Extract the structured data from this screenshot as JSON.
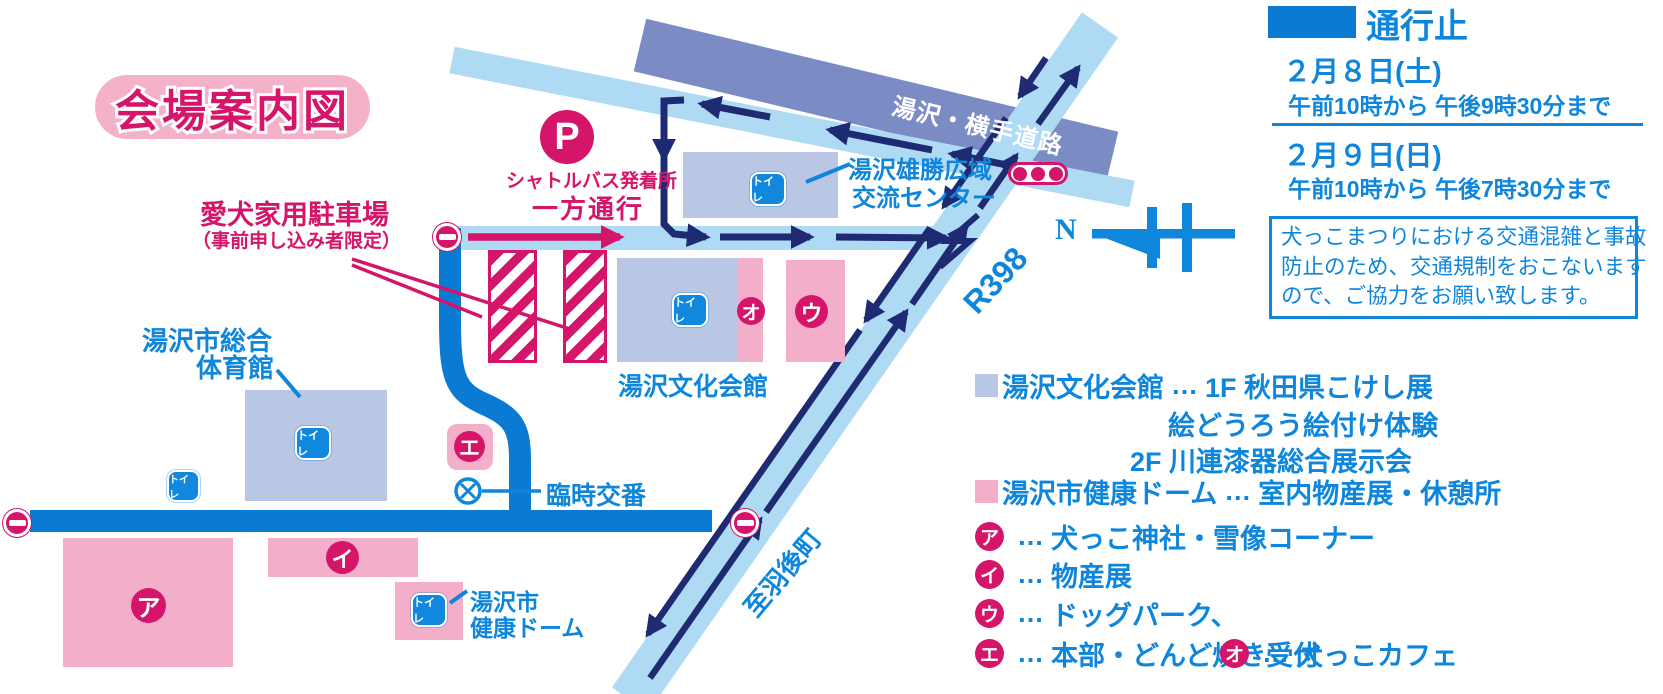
{
  "title": "会場案内図",
  "closure_legend": {
    "label": "通行止",
    "entries": [
      {
        "date": "２月８日(土)",
        "time": "午前10時から 午後9時30分まで"
      },
      {
        "date": "２月９日(日)",
        "time": "午前10時から 午後7時30分まで"
      }
    ],
    "notice_lines": [
      "犬っこまつりにおける交通混雑と事故",
      "防止のため、交通規制をおこないます",
      "ので、ご協力をお願い致します。"
    ]
  },
  "compass": {
    "label": "N"
  },
  "roads": {
    "yokote": "湯沢・横手道路",
    "r398": "R398",
    "ugo": "至羽後町"
  },
  "map_labels": {
    "parking_title": "愛犬家用駐車場",
    "parking_sub": "（事前申し込み者限定）",
    "shuttle_p": "P",
    "shuttle": "シャトルバス発着所",
    "one_way": "一方通行",
    "koryu_center_l1": "湯沢雄勝広域",
    "koryu_center_l2": "交流センター",
    "bunka_kaikan": "湯沢文化会館",
    "gym_l1": "湯沢市総合",
    "gym_l2": "体育館",
    "police": "臨時交番",
    "dome_l1": "湯沢市",
    "dome_l2": "健康ドーム",
    "toilet": "トイレ"
  },
  "markers": {
    "a": "ア",
    "i": "イ",
    "u": "ウ",
    "e": "エ",
    "o": "オ"
  },
  "venue_legend": {
    "bunka": {
      "name": "湯沢文化会館",
      "sep": "…",
      "desc1": "1F 秋田県こけし展",
      "desc2": "絵どうろう絵付け体験",
      "desc3": "2F 川連漆器総合展示会"
    },
    "dome": {
      "name": "湯沢市健康ドーム",
      "sep": "…",
      "desc": "室内物産展・休憩所"
    },
    "items": [
      {
        "badge": "ア",
        "sep": "…",
        "desc": "犬っこ神社・雪像コーナー"
      },
      {
        "badge": "イ",
        "sep": "…",
        "desc": "物産展"
      },
      {
        "badge": "ウ",
        "sep": "…",
        "desc": "ドッグパーク、"
      },
      {
        "badge": "エ",
        "sep": "…",
        "desc": "本部・どんど焼き受付"
      },
      {
        "badge": "オ",
        "sep": "…",
        "desc": "犬っこカフェ"
      }
    ]
  },
  "colors": {
    "crimson": "#d4156a",
    "pink": "#f3afc9",
    "blue_text": "#0e86dc",
    "closed_road_blue": "#0a7ad2",
    "light_blue_road": "#aedaf4",
    "slate_road": "#7b8cc4",
    "navy_arrow": "#1e2b72",
    "building_blue": "#b9c7e4",
    "toilet_blue": "#1287de"
  }
}
